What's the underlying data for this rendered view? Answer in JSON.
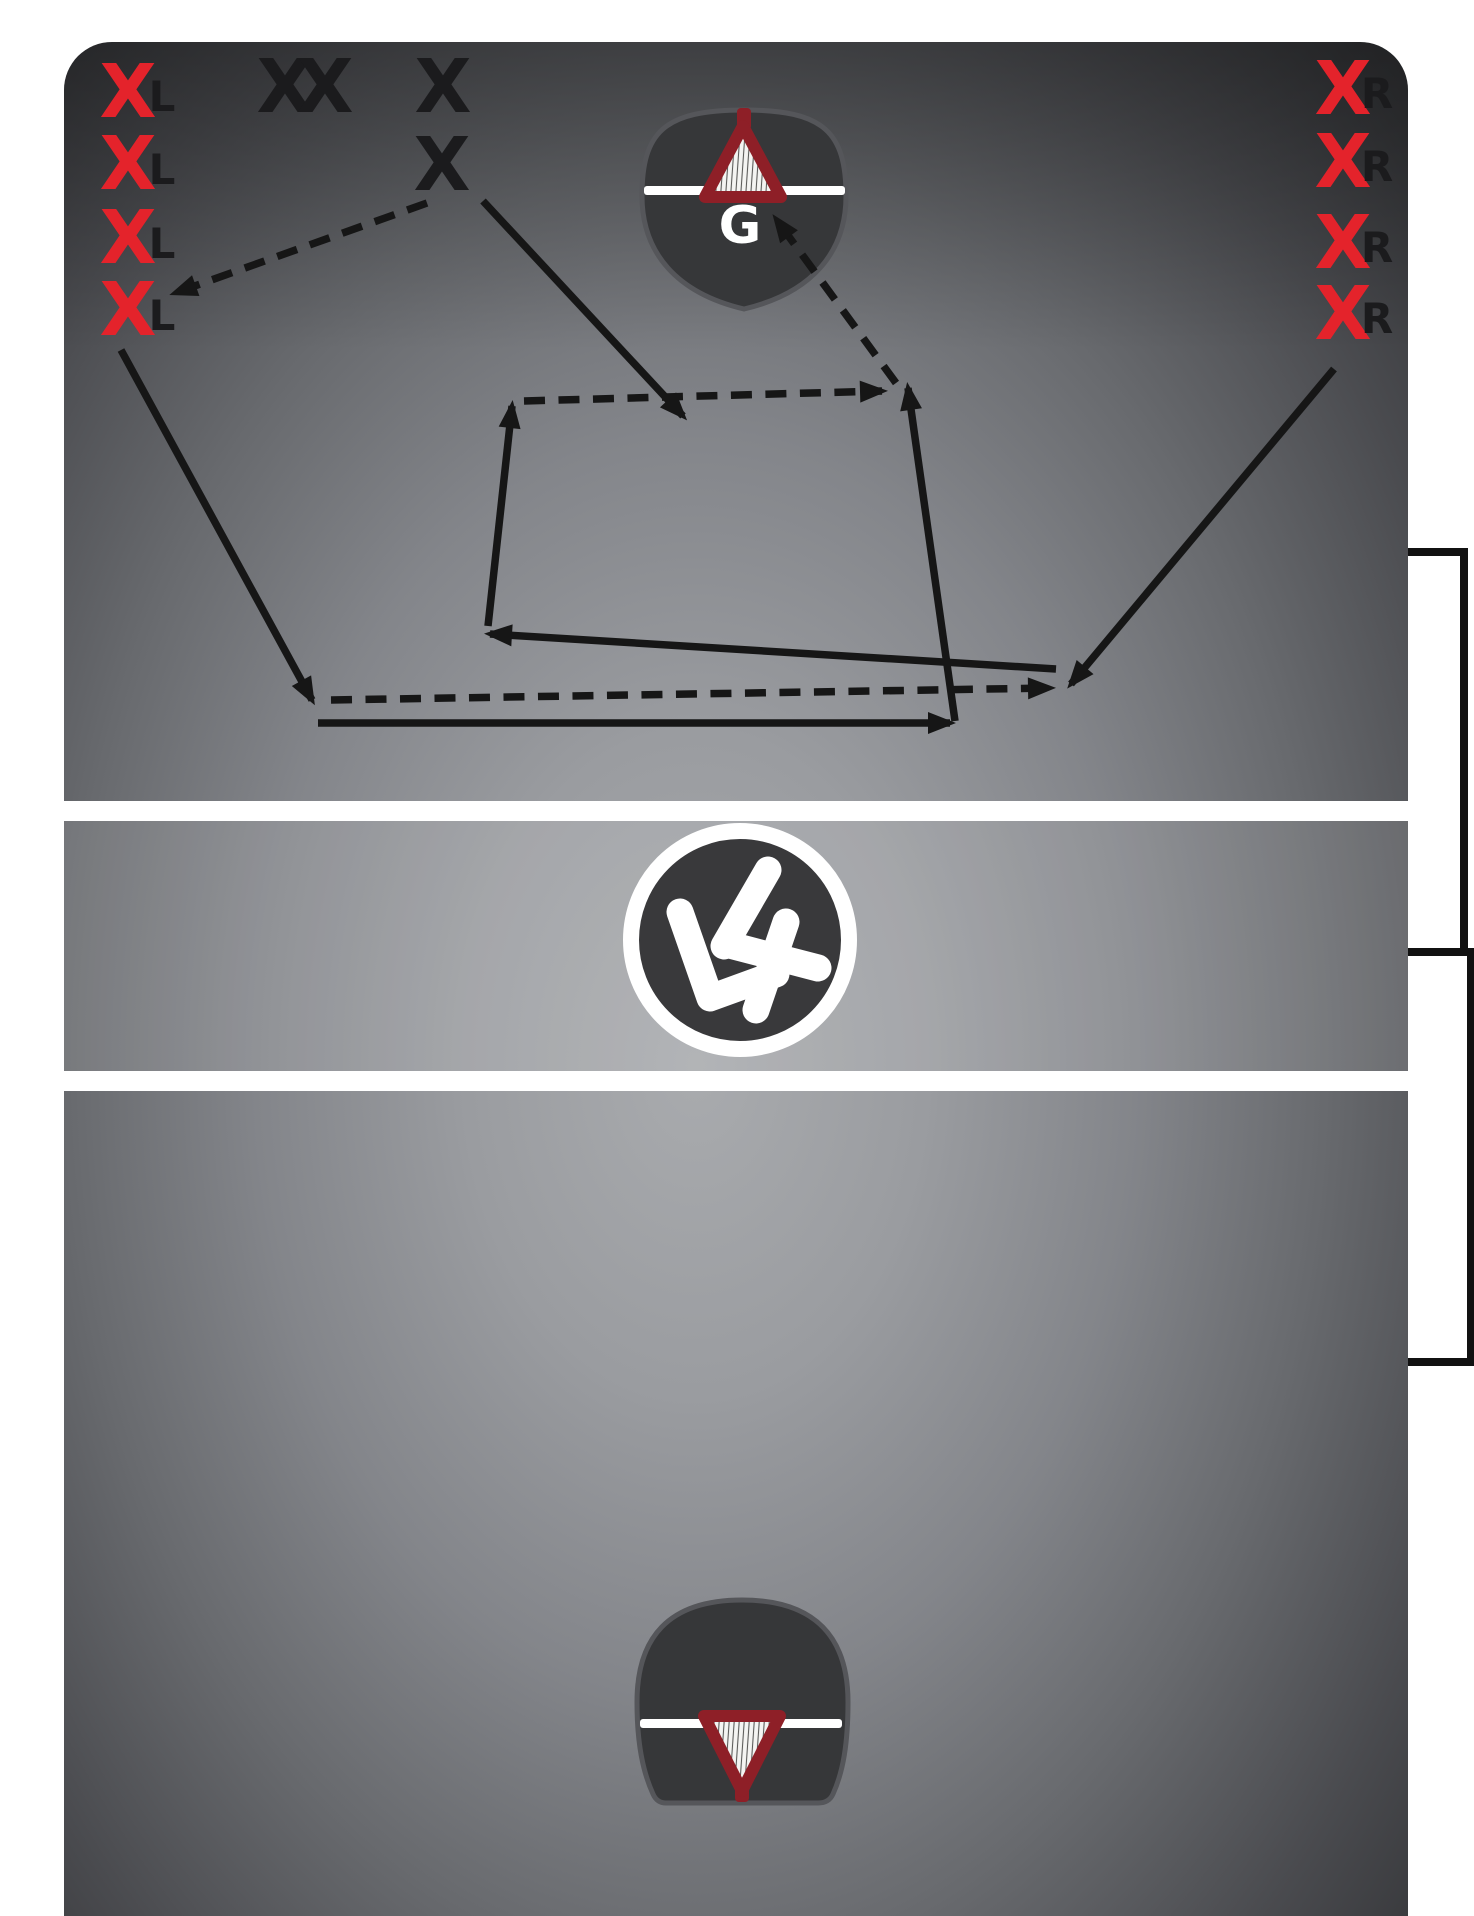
{
  "title": "lacrosse-drill-diagram",
  "colors": {
    "page_bg": "#ffffff",
    "line_white": "#ffffff",
    "arrow_ink": "#161616",
    "bracket_ink": "#111111",
    "player_red": "#e4232b",
    "player_black": "#1b1b1d",
    "label_ink": "#1b1b1d",
    "goal_fill": "#363739",
    "goal_edge": "#55565a",
    "goal_triangle_red": "#8e1f27",
    "goalie_text": "#ffffff",
    "center_circle_fill": "#39393b",
    "logo_white": "#ffffff"
  },
  "field": {
    "x": 64,
    "y": 42,
    "w": 1344,
    "h": 1930,
    "corner_radius": 48,
    "band1_y": 801,
    "band2_y": 1071,
    "band_h": 20,
    "midzone_y": 821,
    "midzone_h": 250
  },
  "players": [
    {
      "id": "left-1",
      "symbol": "X",
      "label": "L",
      "x": 128,
      "y": 90,
      "lx": 162,
      "ly": 95,
      "color": "player_red"
    },
    {
      "id": "left-2",
      "symbol": "X",
      "label": "L",
      "x": 128,
      "y": 162,
      "lx": 162,
      "ly": 168,
      "color": "player_red"
    },
    {
      "id": "left-3",
      "symbol": "X",
      "label": "L",
      "x": 128,
      "y": 236,
      "lx": 162,
      "ly": 242,
      "color": "player_red"
    },
    {
      "id": "left-4",
      "symbol": "X",
      "label": "L",
      "x": 128,
      "y": 308,
      "lx": 162,
      "ly": 314,
      "color": "player_red"
    },
    {
      "id": "right-1",
      "symbol": "X",
      "label": "R",
      "x": 1343,
      "y": 87,
      "lx": 1377,
      "ly": 92,
      "color": "player_red"
    },
    {
      "id": "right-2",
      "symbol": "X",
      "label": "R",
      "x": 1343,
      "y": 160,
      "lx": 1377,
      "ly": 165,
      "color": "player_red"
    },
    {
      "id": "right-3",
      "symbol": "X",
      "label": "R",
      "x": 1343,
      "y": 241,
      "lx": 1377,
      "ly": 246,
      "color": "player_red"
    },
    {
      "id": "right-4",
      "symbol": "X",
      "label": "R",
      "x": 1343,
      "y": 312,
      "lx": 1377,
      "ly": 317,
      "color": "player_red"
    },
    {
      "id": "mid-1",
      "symbol": "X",
      "label": "",
      "x": 285,
      "y": 85,
      "color": "player_black"
    },
    {
      "id": "mid-2",
      "symbol": "X",
      "label": "",
      "x": 325,
      "y": 85,
      "color": "player_black"
    },
    {
      "id": "mid-3",
      "symbol": "X",
      "label": "",
      "x": 443,
      "y": 85,
      "color": "player_black"
    },
    {
      "id": "mid-4",
      "symbol": "X",
      "label": "",
      "x": 442,
      "y": 163,
      "color": "player_black"
    }
  ],
  "goalie": {
    "label": "G",
    "x": 740,
    "y": 243
  },
  "goals": {
    "top": {
      "cx": 744,
      "line_y": 186,
      "line_x": 644,
      "line_w": 201
    },
    "bottom": {
      "cx": 742,
      "line_y": 1719,
      "line_x": 640,
      "line_w": 202
    }
  },
  "center_logo": {
    "cx": 740,
    "cy": 940,
    "r": 109,
    "ring_width": 16,
    "stroke_width": 27,
    "strokes": [
      [
        [
          -60,
          -28
        ],
        [
          -30,
          58
        ],
        [
          36,
          34
        ]
      ],
      [
        [
          28,
          -70
        ],
        [
          -16,
          6
        ]
      ],
      [
        [
          -14,
          4
        ],
        [
          78,
          28
        ]
      ],
      [
        [
          46,
          -18
        ],
        [
          16,
          70
        ]
      ]
    ]
  },
  "arrows": {
    "solid": [
      {
        "id": "run-left4-down",
        "x1": 121,
        "y1": 350,
        "x2": 312,
        "y2": 700
      },
      {
        "id": "run-baseline-right",
        "x1": 318,
        "y1": 723,
        "x2": 950,
        "y2": 723
      },
      {
        "id": "run-up-right",
        "x1": 955,
        "y1": 721,
        "x2": 908,
        "y2": 388
      },
      {
        "id": "run-up-left",
        "x1": 488,
        "y1": 626,
        "x2": 512,
        "y2": 406
      },
      {
        "id": "run-midX-down",
        "x1": 483,
        "y1": 201,
        "x2": 683,
        "y2": 416
      },
      {
        "id": "run-right4-cross",
        "x1": 1334,
        "y1": 369,
        "x2": 1071,
        "y2": 684
      },
      {
        "id": "run-return-left",
        "x1": 1056,
        "y1": 669,
        "x2": 490,
        "y2": 634
      }
    ],
    "dashed": [
      {
        "id": "pass-midX-to-left4",
        "x1": 427,
        "y1": 203,
        "x2": 175,
        "y2": 293
      },
      {
        "id": "pass-low-right",
        "x1": 331,
        "y1": 700,
        "x2": 1050,
        "y2": 688
      },
      {
        "id": "pass-mid-right",
        "x1": 524,
        "y1": 401,
        "x2": 882,
        "y2": 391
      },
      {
        "id": "shot-to-goal",
        "x1": 896,
        "y1": 383,
        "x2": 776,
        "y2": 219
      }
    ]
  },
  "brackets": [
    {
      "id": "zone-bracket-1",
      "x_field": 1408,
      "x_out": 1464,
      "y1": 552,
      "y2": 952
    },
    {
      "id": "zone-bracket-2",
      "x_field": 1408,
      "x_out": 1471,
      "y1": 952,
      "y2": 1362
    }
  ],
  "style": {
    "x_font": 74,
    "label_font": 42,
    "g_font": 52,
    "line_width": 7.5,
    "dash_pattern": "21 13.5"
  }
}
